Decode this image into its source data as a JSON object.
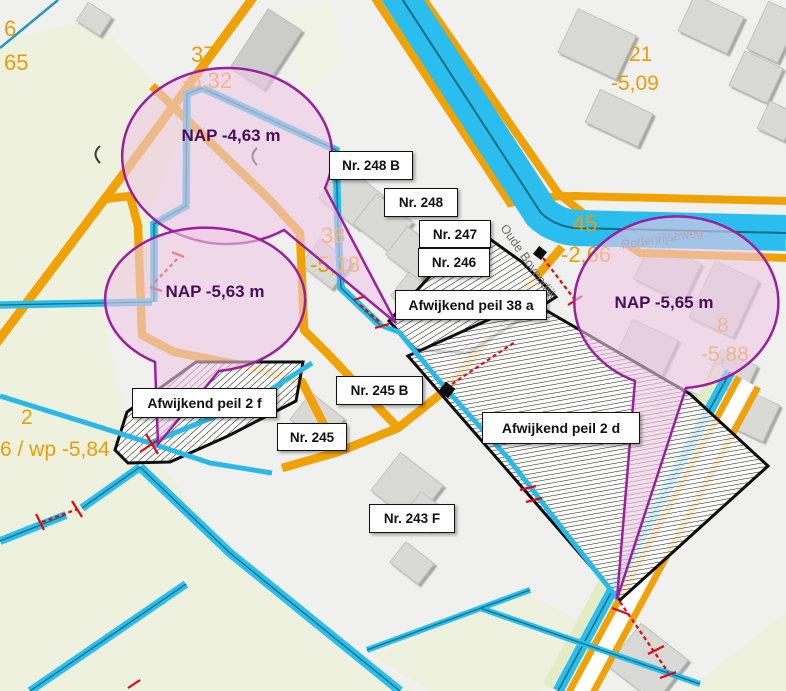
{
  "map": {
    "balloons": [
      {
        "text": "NAP -4,63 m"
      },
      {
        "text": "NAP -5,63 m"
      },
      {
        "text": "NAP -5,65 m"
      }
    ],
    "house_labels": [
      {
        "text": "Nr. 248 B"
      },
      {
        "text": "Nr. 248"
      },
      {
        "text": "Nr. 247"
      },
      {
        "text": "Nr. 246"
      },
      {
        "text": "Nr. 245 B"
      },
      {
        "text": "Nr. 245"
      },
      {
        "text": "Nr. 243 F"
      }
    ],
    "area_labels": [
      {
        "text": "Afwijkend peil 38 a"
      },
      {
        "text": "Afwijkend peil 2 f"
      },
      {
        "text": "Afwijkend peil 2 d"
      }
    ],
    "street_labels": [
      {
        "text": "Oude Bovendijk"
      },
      {
        "text": "Rodenrijseweg"
      }
    ],
    "peil_labels": [
      {
        "text": "6"
      },
      {
        "text": "65"
      },
      {
        "text": "37"
      },
      {
        "text": "-5,32"
      },
      {
        "text": "38"
      },
      {
        "text": "-5,18"
      },
      {
        "text": "21"
      },
      {
        "text": "-5,09"
      },
      {
        "text": "45"
      },
      {
        "text": "-2,66"
      },
      {
        "text": "8"
      },
      {
        "text": "-5,88"
      },
      {
        "text": "2"
      },
      {
        "text": "6 / wp -5,84"
      }
    ],
    "colors": {
      "water": "#2bbdee",
      "water_line": "#116d7d",
      "road": "#f0a202",
      "field": "#eef1dd",
      "urban": "#f0f0ee",
      "building": "#d9d9d6",
      "balloon_fill": "#efc9e4",
      "balloon_stroke": "#9c1f9e",
      "marker_red": "#e30613",
      "label_orange": "#ea9e06"
    }
  }
}
